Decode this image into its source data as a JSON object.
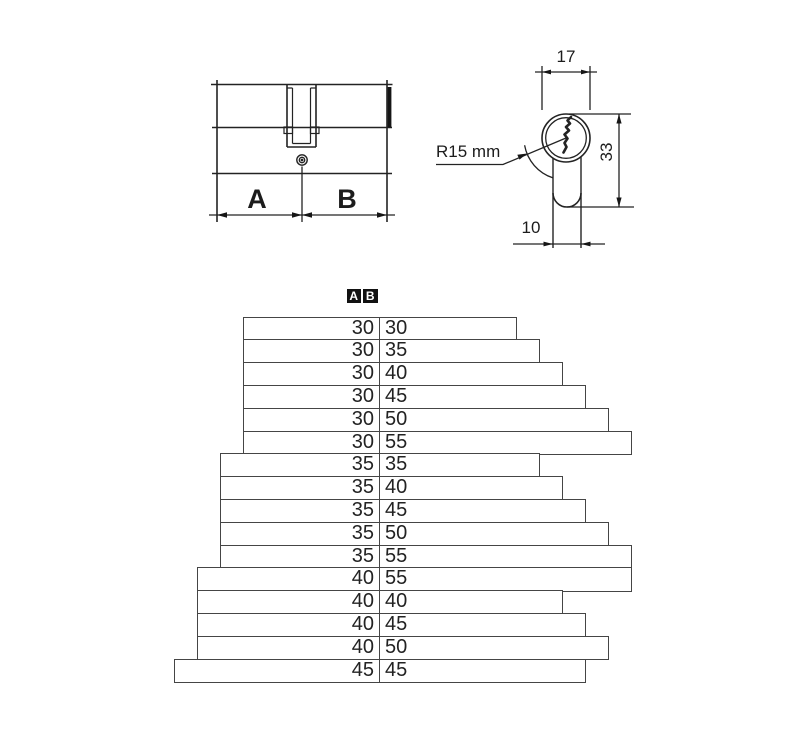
{
  "drawing": {
    "side_view": {
      "label_a": "A",
      "label_b": "B"
    },
    "front_view": {
      "width_mm": "17",
      "height_mm": "33",
      "stem_width_mm": "10",
      "radius_label": "R15 mm"
    }
  },
  "size_table": {
    "header": {
      "a": "A",
      "b": "B"
    },
    "rows": [
      {
        "a": "30",
        "b": "30"
      },
      {
        "a": "30",
        "b": "35"
      },
      {
        "a": "30",
        "b": "40"
      },
      {
        "a": "30",
        "b": "45"
      },
      {
        "a": "30",
        "b": "50"
      },
      {
        "a": "30",
        "b": "55"
      },
      {
        "a": "35",
        "b": "35"
      },
      {
        "a": "35",
        "b": "40"
      },
      {
        "a": "35",
        "b": "45"
      },
      {
        "a": "35",
        "b": "50"
      },
      {
        "a": "35",
        "b": "55"
      },
      {
        "a": "40",
        "b": "55"
      },
      {
        "a": "40",
        "b": "40"
      },
      {
        "a": "40",
        "b": "45"
      },
      {
        "a": "40",
        "b": "50"
      },
      {
        "a": "45",
        "b": "45"
      }
    ]
  },
  "colors": {
    "line": "#232323",
    "bar_border": "#454545",
    "header_bg": "#121212"
  }
}
